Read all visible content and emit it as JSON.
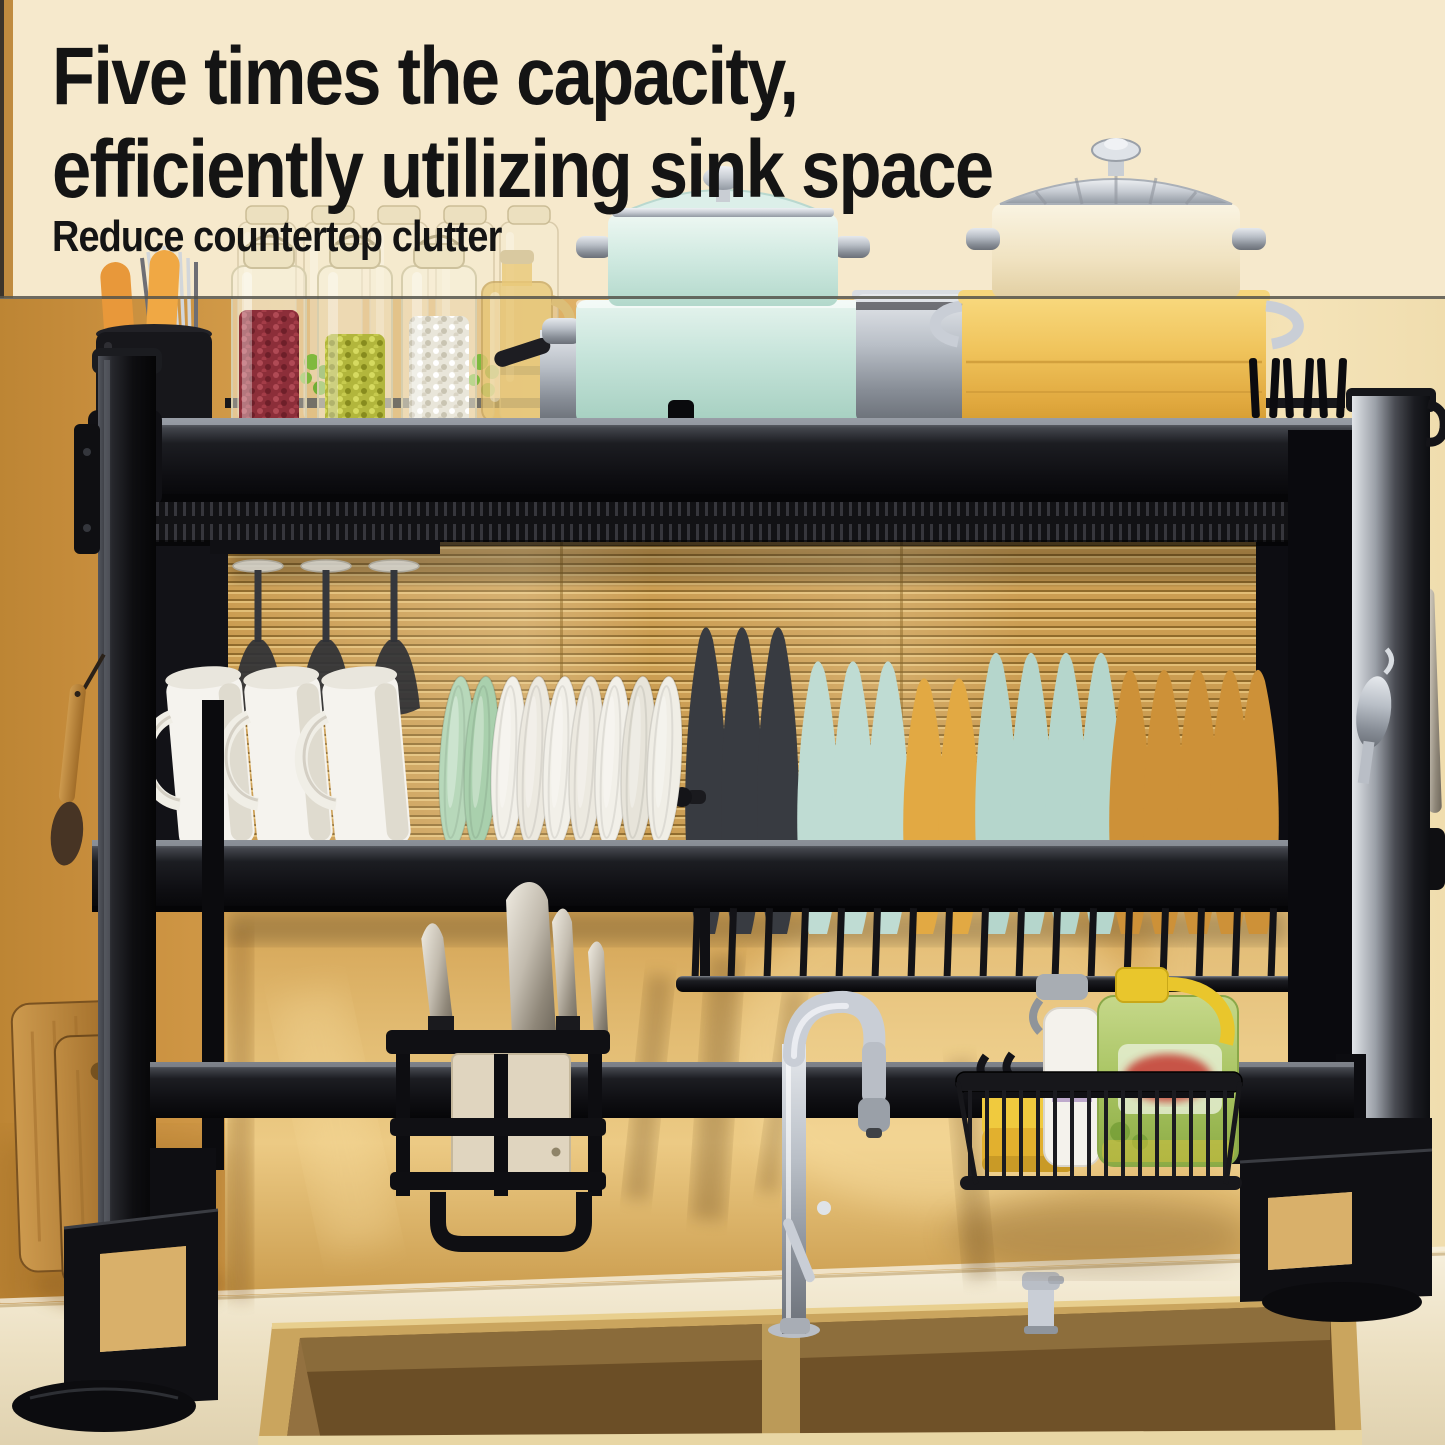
{
  "headline": {
    "line1": "Five times the capacity,",
    "line2": "efficiently utilizing sink space",
    "subheadline": "Reduce countertop clutter"
  },
  "palette": {
    "headline_text": "#141414",
    "top_banner": "#f6e9cc",
    "divider_line": "#55534b",
    "wall_left_tan": "#c98f3e",
    "blind_gold": "#c99a4e",
    "wall_glossy_gold": "#e3bd74",
    "counter_cream": "#ece0c2",
    "rack_black": "#111115",
    "steel": "#b9bfc7",
    "mint_pot": "#cfe9e0",
    "yellow_pot": "#f0c45c",
    "cream_pot": "#f0e2c0",
    "mug_white": "#f5f3ee",
    "bowl_green": "#bcdcc0",
    "plate_dark": "#383b41",
    "plate_teal": "#bfdcd3",
    "plate_yellow": "#e2a943",
    "plate_amber": "#cd9138",
    "beans_red": "#8c2e39",
    "beans_green": "#b2b63c",
    "beans_white": "#e9e6da",
    "sponge_yellow": "#f0ca3e",
    "soap_jug_green": "#a8c462",
    "soap_cap_yellow": "#e9c62c",
    "wood_board": "#cd9a4e",
    "sink_bronze": "#8a6b38"
  },
  "scene": {
    "description": "Over-the-sink two-tier black dish drying rack above a double-basin gold sink",
    "top_shelf": [
      "utensil-holder",
      "orange-handled-spoons",
      "metal-skewers",
      "glass-canisters",
      "jar-red-beans",
      "jar-mung-beans",
      "jar-white-beans",
      "oil-bottle",
      "steel-pot",
      "mint-pot-stack-with-lid",
      "yellow-pot-stack",
      "cream-pot-with-steel-lid",
      "corner-hooks"
    ],
    "middle_shelf": [
      "hanging-stemware",
      "white-mugs",
      "green-bowls",
      "white-bowls",
      "dark-plates",
      "teal-plates",
      "yellow-plates",
      "amber-plates",
      "cutlery-rack"
    ],
    "below_rack": [
      "cutting-boards",
      "knife-holder",
      "cleaver",
      "knives",
      "gooseneck-faucet",
      "wire-basket",
      "sponge",
      "spray-bottle",
      "dish-soap-jug",
      "soap-dispenser"
    ],
    "environment": [
      "cream-wall",
      "striped-blind",
      "glossy-gold-backsplash",
      "double-basin-sink",
      "countertop"
    ]
  },
  "geometry": {
    "glasses": [
      258,
      326,
      394
    ],
    "mugs": [
      218,
      296,
      374
    ],
    "bowls": [
      {
        "x": 452,
        "c": "#b7d8ba"
      },
      {
        "x": 477,
        "c": "#a9d0ad"
      },
      {
        "x": 504,
        "c": "#f2f0e9"
      },
      {
        "x": 530,
        "c": "#ece9e0"
      },
      {
        "x": 556,
        "c": "#f2f0e9"
      },
      {
        "x": 582,
        "c": "#ece9e0"
      },
      {
        "x": 608,
        "c": "#f2f0e9"
      },
      {
        "x": 634,
        "c": "#e7e4da"
      },
      {
        "x": 660,
        "c": "#f0eee6"
      }
    ],
    "plates": [
      {
        "c": "#383b41",
        "h": 1.08,
        "xs": [
          706,
          742,
          778
        ]
      },
      {
        "c": "#bfdcd3",
        "h": 0.96,
        "xs": [
          818,
          853,
          888
        ]
      },
      {
        "c": "#e2a943",
        "h": 0.9,
        "xs": [
          924,
          959
        ]
      },
      {
        "c": "#b5d6cc",
        "h": 0.99,
        "xs": [
          996,
          1031,
          1066,
          1101
        ]
      },
      {
        "c": "#cd9138",
        "h": 0.93,
        "xs": [
          1130,
          1164,
          1198,
          1230,
          1258
        ]
      }
    ],
    "jars": [
      {
        "x": 232,
        "p": "pBeanRed",
        "fy": 310
      },
      {
        "x": 318,
        "p": "pBeanGreen",
        "fy": 334
      },
      {
        "x": 402,
        "p": "pBeanWhite",
        "fy": 316
      }
    ],
    "canisters": [
      238,
      304,
      370,
      436,
      500
    ],
    "top_prongs": [
      1252,
      1269,
      1286,
      1303,
      1320,
      1336
    ],
    "comb": {
      "x0": 694,
      "x1": 1336,
      "step": 36
    },
    "wires": {
      "x0": 968,
      "x1": 1232,
      "step": 17
    }
  }
}
